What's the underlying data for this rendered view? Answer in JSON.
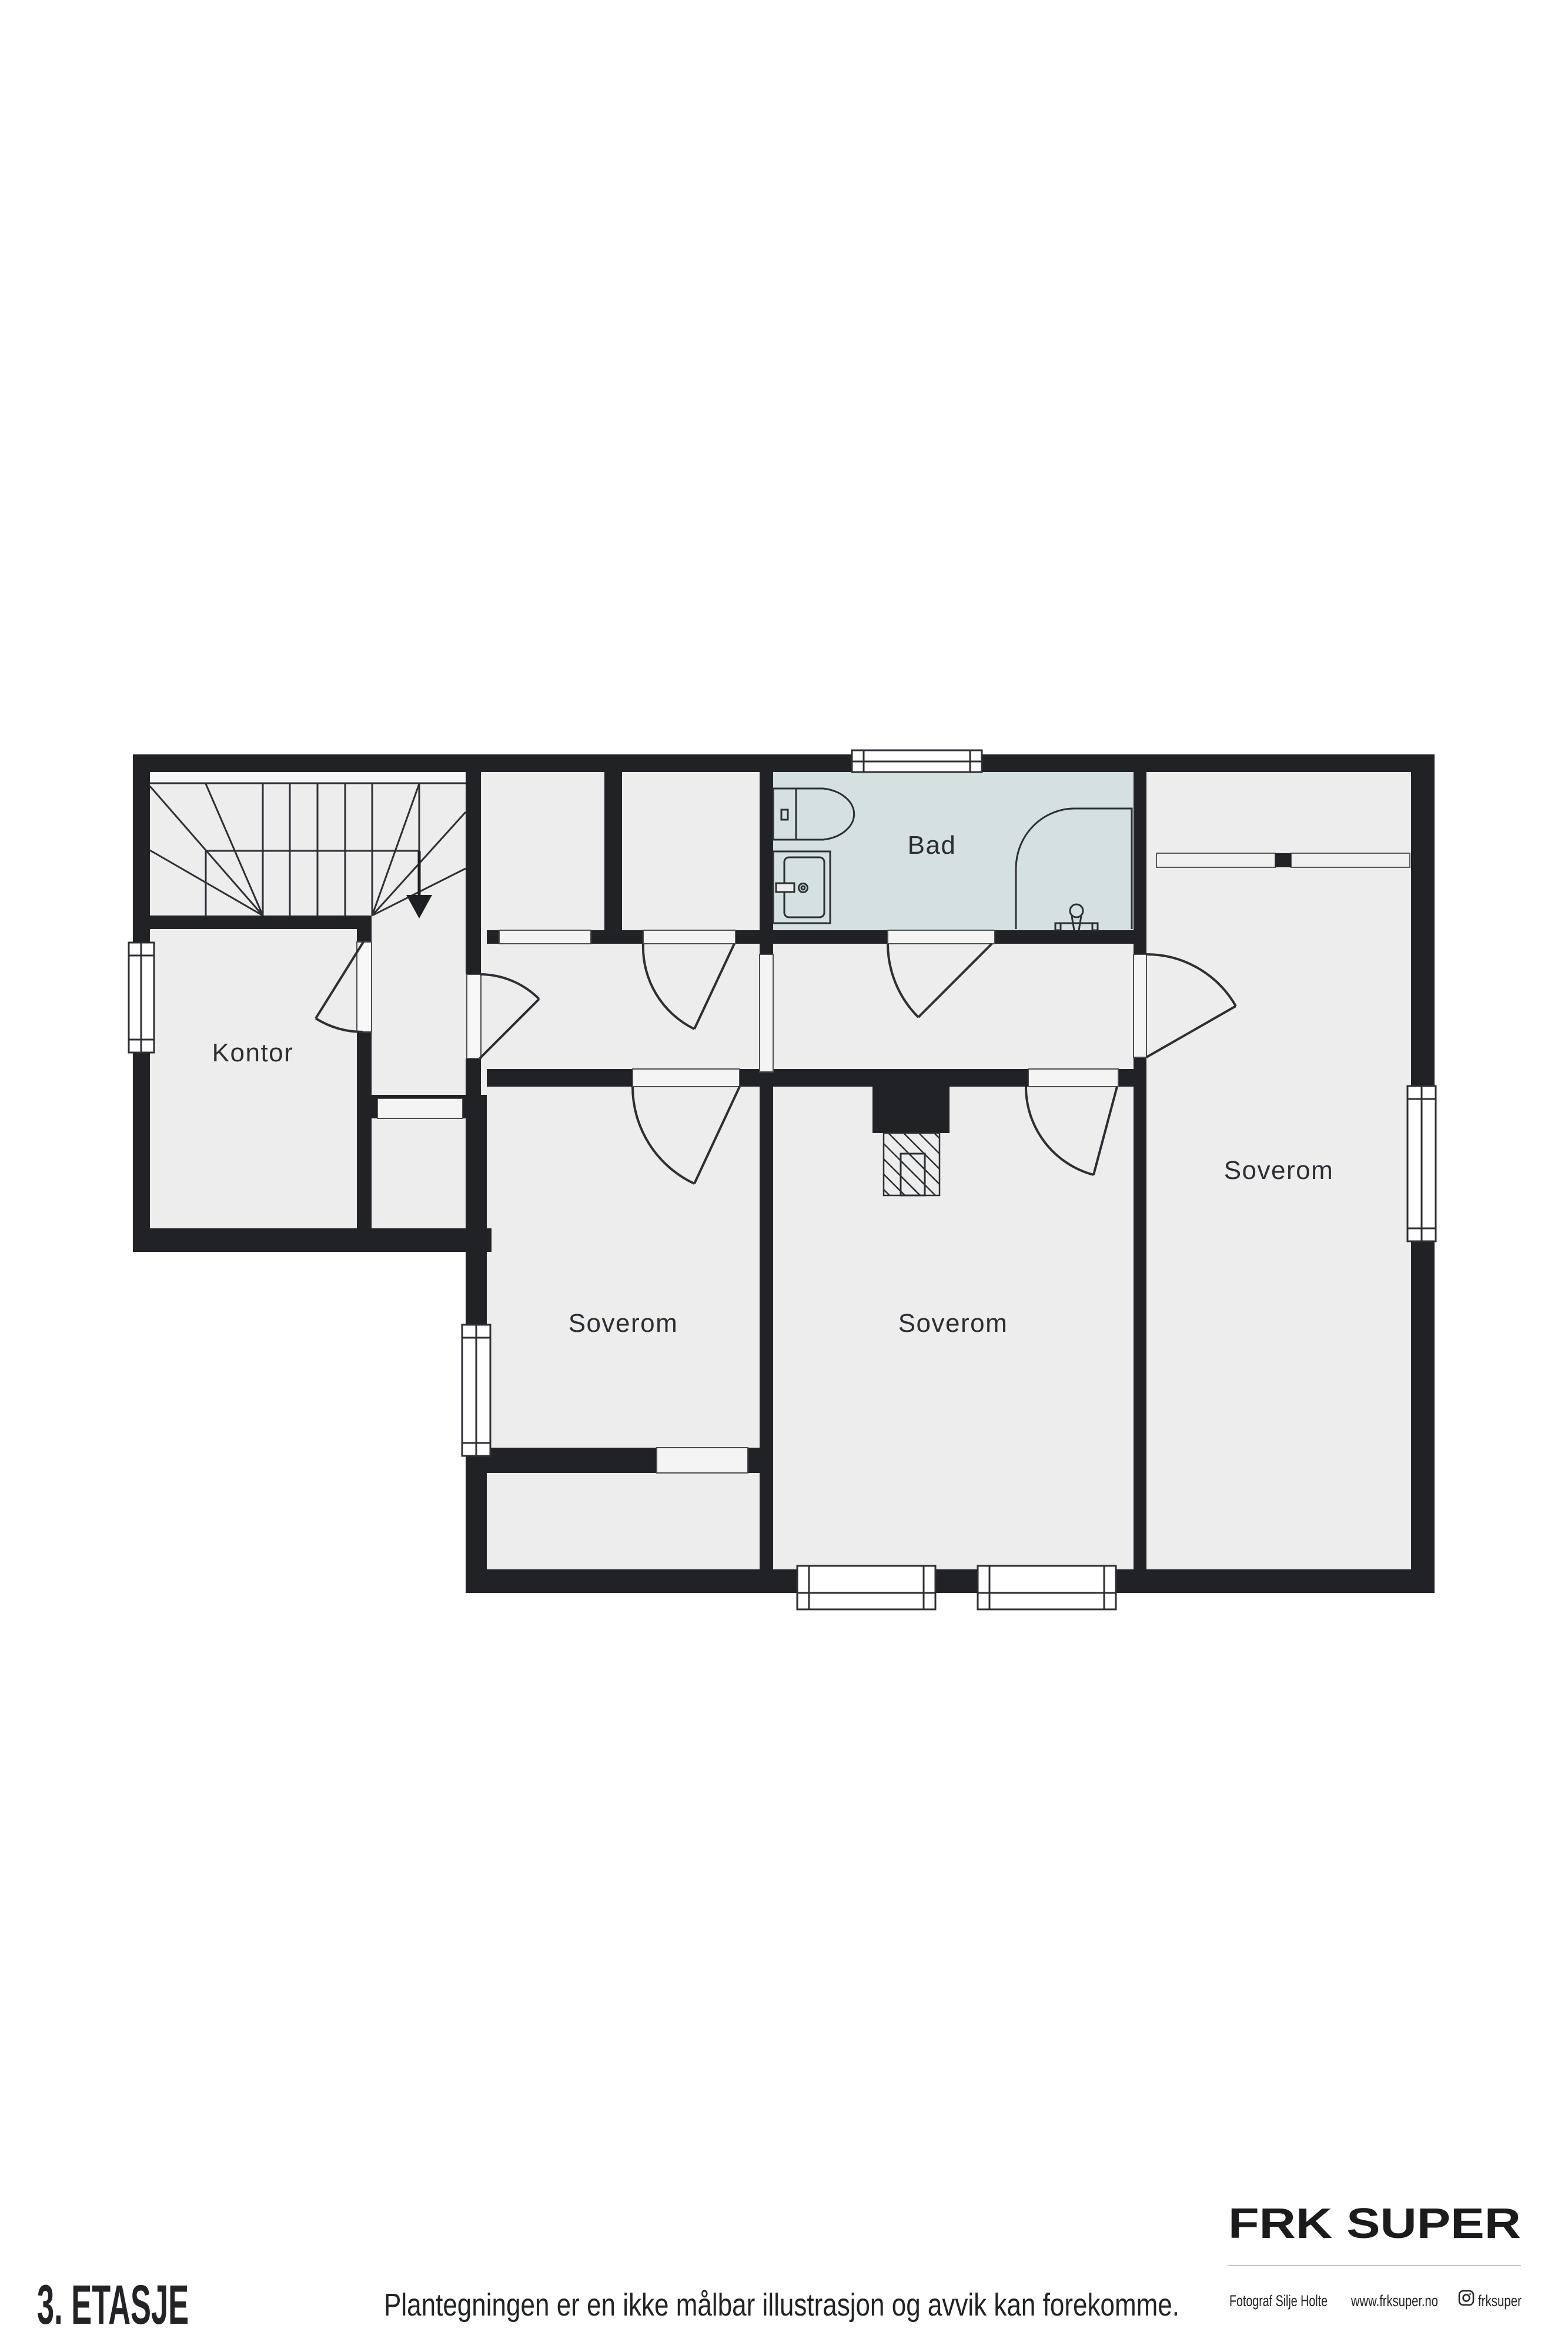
{
  "title": "3. ETASJE",
  "disclaimer": "Plantegningen er en ikke målbar illustrasjon og avvik kan forekomme.",
  "rooms": {
    "office": "Kontor",
    "bath": "Bad",
    "bedroom": "Soverom"
  },
  "brand": {
    "name": "FRK SUPER",
    "photographer": "Fotograf Silje Holte",
    "website": "www.frksuper.no",
    "instagram": "frksuper"
  },
  "colors": {
    "wall": "#212226",
    "floor": "#ededee",
    "bathroom_floor": "#d5e1e1",
    "stair_band": "#f6f7f8",
    "threshold": "#f4f4f5",
    "line": "#2c2f33",
    "paper": "#ffffff"
  }
}
